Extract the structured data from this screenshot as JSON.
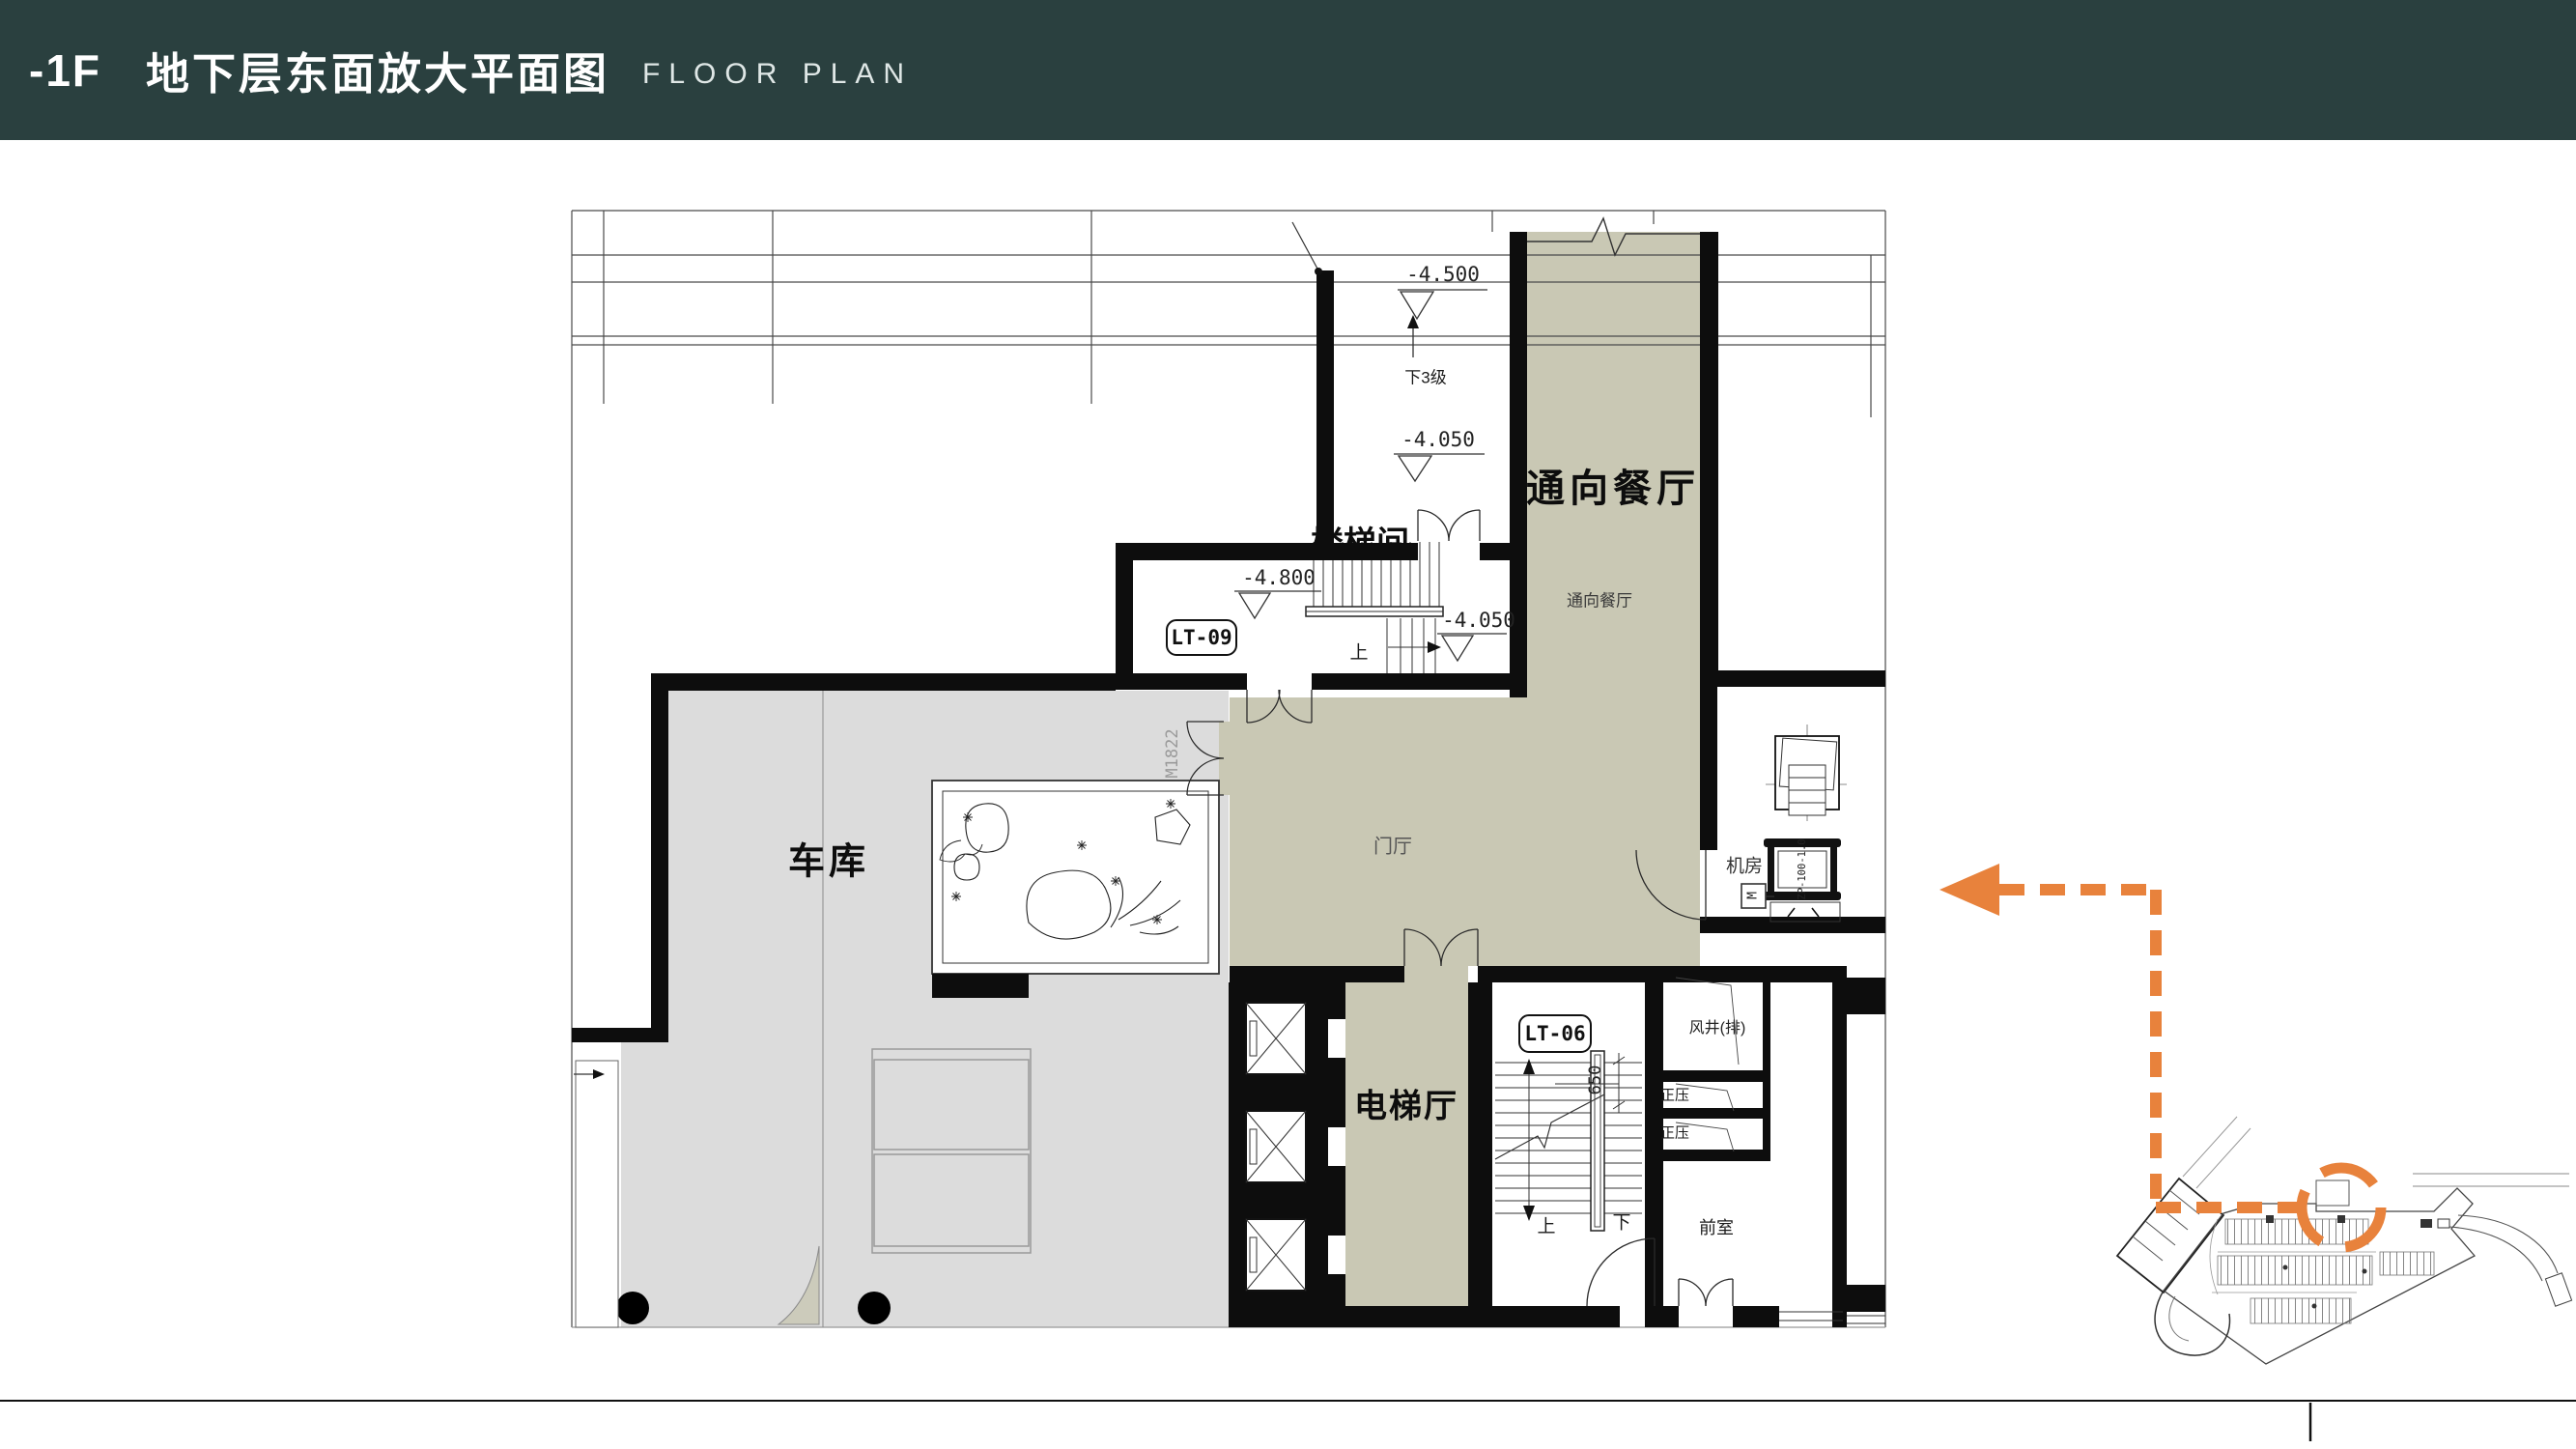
{
  "header": {
    "floor_tag": "-1F",
    "title": "地下层东面放大平面图",
    "subtitle": "FLOOR PLAN"
  },
  "labels": {
    "corridor_main": "通向餐厅",
    "corridor_sub": "通向餐厅",
    "garage": "车库",
    "foyer": "门厅",
    "elevator_hall": "电梯厅",
    "stair_room_top": "楼梯间",
    "machine_room": "机房",
    "air_shaft": "风井(排)",
    "pressure_1": "正压",
    "pressure_2": "正压",
    "front_room": "前室",
    "badge_lt09": "LT-09",
    "badge_lt06": "LT-06",
    "door_m1822": "M1822",
    "fan_model": "ZP-100-1.0",
    "motor": "M",
    "dim_650": "650",
    "down_3_steps": "下3级",
    "up_lt09": "上",
    "up_lt06": "上",
    "down_lt06": "下",
    "elev_4500": "-4.500",
    "elev_4050_a": "-4.050",
    "elev_4800": "-4.800",
    "elev_4050_b": "-4.050"
  },
  "colors": {
    "header_bg": "#2a403f",
    "room_fill": "#c9c8b4",
    "garage_fill": "#dcdcdc",
    "wall": "#0d0d0d",
    "accent_orange": "#e8823c"
  }
}
